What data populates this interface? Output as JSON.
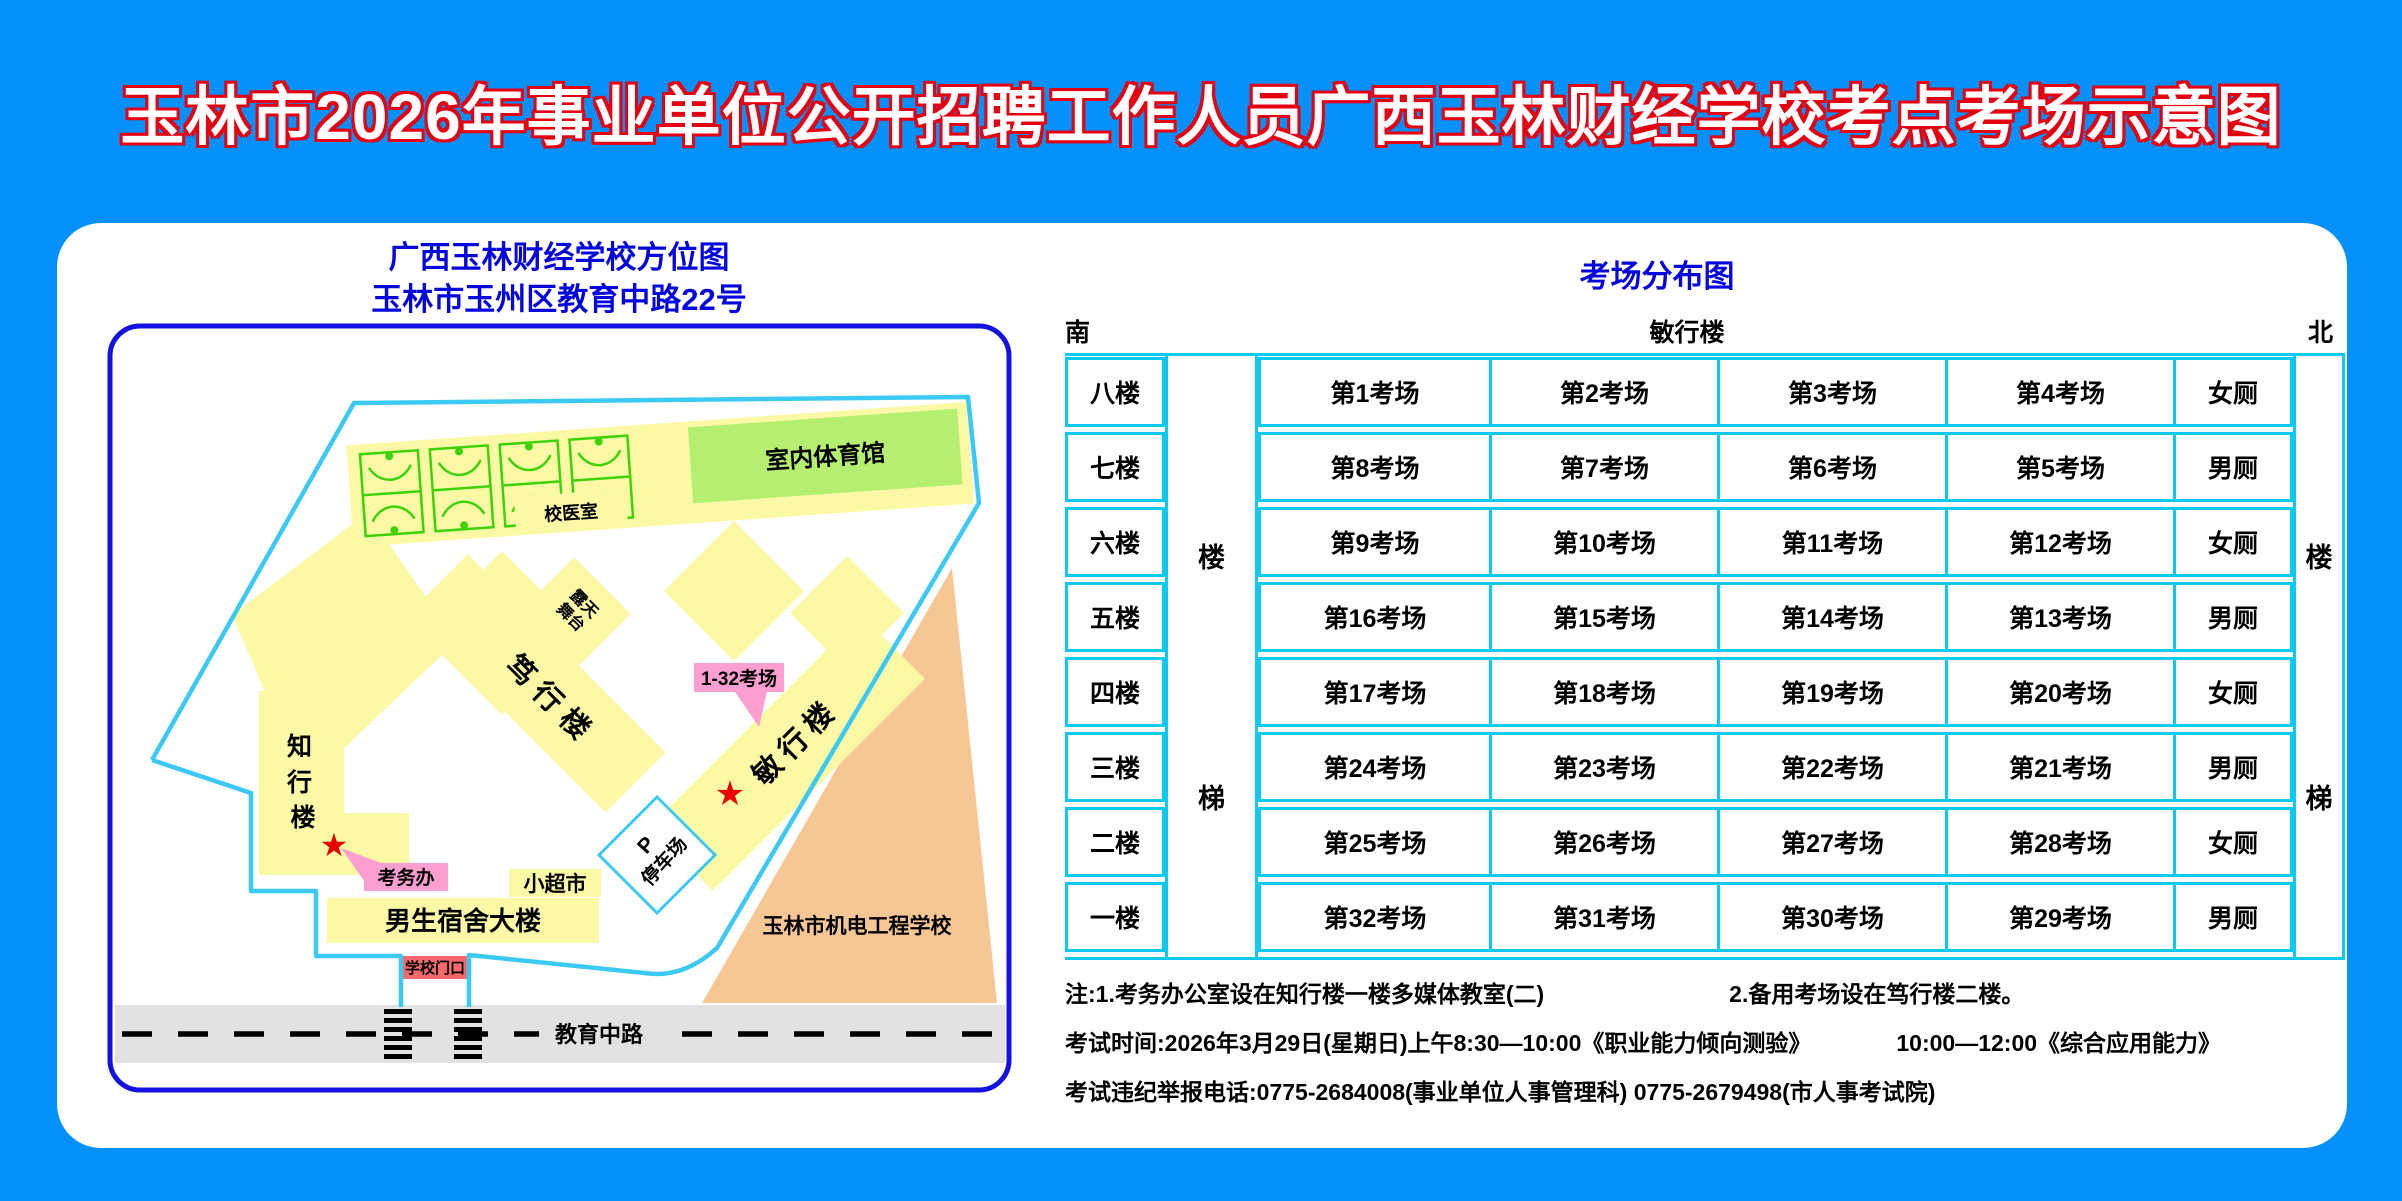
{
  "title": "玉林市2026年事业单位公开招聘工作人员广西玉林财经学校考点考场示意图",
  "map": {
    "header_line1": "广西玉林财经学校方位图",
    "header_line2": "玉林市玉州区教育中路22号",
    "gym_label": "室内体育馆",
    "clinic_label": "校医室",
    "stage_line1": "露天",
    "stage_line2": "舞台",
    "duxing_label": "笃行楼",
    "minxing_label": "敏行楼",
    "zhixing_chars": [
      "知",
      "行",
      "楼"
    ],
    "exam_rooms_callout": "1-32考场",
    "exam_office_callout": "考务办",
    "supermarket_label": "小超市",
    "dorm_label": "男生宿舍大楼",
    "gate_label": "学校门口",
    "parking_p": "P",
    "parking_label": "停车场",
    "road_label": "教育中路",
    "other_school_label": "玉林市机电工程学校",
    "star": "★"
  },
  "distribution": {
    "title": "考场分布图",
    "south": "南",
    "building": "敏行楼",
    "north": "北",
    "stair_top": "楼",
    "stair_bottom": "梯",
    "floors": [
      {
        "floor": "八楼",
        "rooms": [
          "第1考场",
          "第2考场",
          "第3考场",
          "第4考场"
        ],
        "wc": "女厕"
      },
      {
        "floor": "七楼",
        "rooms": [
          "第8考场",
          "第7考场",
          "第6考场",
          "第5考场"
        ],
        "wc": "男厕"
      },
      {
        "floor": "六楼",
        "rooms": [
          "第9考场",
          "第10考场",
          "第11考场",
          "第12考场"
        ],
        "wc": "女厕"
      },
      {
        "floor": "五楼",
        "rooms": [
          "第16考场",
          "第15考场",
          "第14考场",
          "第13考场"
        ],
        "wc": "男厕"
      },
      {
        "floor": "四楼",
        "rooms": [
          "第17考场",
          "第18考场",
          "第19考场",
          "第20考场"
        ],
        "wc": "女厕"
      },
      {
        "floor": "三楼",
        "rooms": [
          "第24考场",
          "第23考场",
          "第22考场",
          "第21考场"
        ],
        "wc": "男厕"
      },
      {
        "floor": "二楼",
        "rooms": [
          "第25考场",
          "第26考场",
          "第27考场",
          "第28考场"
        ],
        "wc": "女厕"
      },
      {
        "floor": "一楼",
        "rooms": [
          "第32考场",
          "第31考场",
          "第30考场",
          "第29考场"
        ],
        "wc": "男厕"
      }
    ]
  },
  "notes": {
    "note1a": "注:1.考务办公室设在知行楼一楼多媒体教室(二)",
    "note1b": "2.备用考场设在笃行楼二楼。",
    "note2a": "考试时间:2026年3月29日(星期日)上午8:30—10:00《职业能力倾向测验》",
    "note2b": "10:00—12:00《综合应用能力》",
    "note3": "考试违纪举报电话:0775-2684008(事业单位人事管理科)  0775-2679498(市人事考试院)"
  },
  "colors": {
    "background": "#0590fa",
    "panel": "#ffffff",
    "title_red": "#e50011",
    "blue_text": "#0505dd",
    "map_border": "#1512e0",
    "boundary_cyan": "#3cc9f3",
    "building_yellow": "#fbf9a6",
    "gym_green": "#b5ef72",
    "court_green": "#3fd20a",
    "callout_pink": "#fb9ed0",
    "gate_red": "#f8696b",
    "other_school_orange": "#f6c794",
    "road_gray": "#e2e2e2",
    "table_border": "#0cc9f2",
    "star_red": "#e80000"
  }
}
